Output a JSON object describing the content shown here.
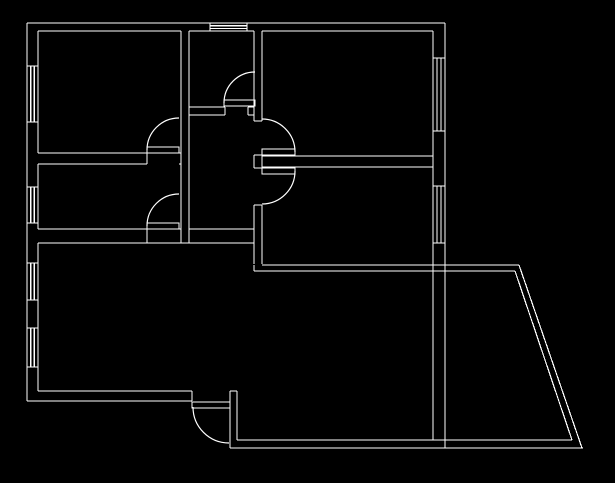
{
  "app": {
    "background_color": "#000000",
    "line_color": "#ffffff",
    "drawing_type": "apartment-floor-plan"
  },
  "plan": {
    "canvas": {
      "width": 615,
      "height": 483
    },
    "exterior_walls": [
      [
        27,
        23,
        445,
        23
      ],
      [
        27,
        23,
        27,
        401
      ],
      [
        445,
        23,
        445,
        448
      ],
      [
        38,
        31,
        181,
        31
      ],
      [
        189,
        31,
        254,
        31
      ],
      [
        262,
        31,
        433,
        31
      ],
      [
        38,
        31,
        38,
        153
      ],
      [
        38,
        164,
        38,
        229
      ],
      [
        38,
        243,
        38,
        391
      ],
      [
        433,
        31,
        433,
        440
      ],
      [
        38,
        391,
        192,
        391
      ],
      [
        27,
        401,
        192,
        401
      ],
      [
        192,
        391,
        192,
        401
      ],
      [
        230,
        391,
        230,
        448
      ],
      [
        237,
        391,
        237,
        440
      ],
      [
        230,
        391,
        237,
        391
      ],
      [
        237,
        440,
        572,
        440
      ],
      [
        230,
        448,
        583,
        448
      ],
      [
        262,
        265,
        519,
        265
      ],
      [
        254,
        271,
        515,
        271
      ],
      [
        254,
        265,
        254,
        271
      ],
      [
        519,
        265,
        582,
        448
      ],
      [
        515,
        271,
        572,
        440
      ]
    ],
    "interior_walls": [
      [
        181,
        31,
        181,
        243
      ],
      [
        189,
        31,
        189,
        243
      ],
      [
        254,
        31,
        254,
        121
      ],
      [
        254,
        155,
        254,
        168
      ],
      [
        254,
        205,
        254,
        264
      ],
      [
        262,
        31,
        262,
        121
      ],
      [
        262,
        155,
        262,
        168
      ],
      [
        262,
        205,
        262,
        264
      ],
      [
        254,
        121,
        262,
        121
      ],
      [
        254,
        155,
        262,
        155
      ],
      [
        254,
        168,
        262,
        168
      ],
      [
        254,
        205,
        262,
        205
      ],
      [
        38,
        153,
        147,
        153
      ],
      [
        38,
        164,
        147,
        164
      ],
      [
        147,
        153,
        147,
        164
      ],
      [
        179,
        153,
        181,
        153
      ],
      [
        179,
        164,
        181,
        164
      ],
      [
        189,
        107,
        225,
        107
      ],
      [
        189,
        115,
        225,
        115
      ],
      [
        248,
        107,
        254,
        107
      ],
      [
        248,
        115,
        254,
        115
      ],
      [
        225,
        107,
        225,
        115
      ],
      [
        248,
        107,
        248,
        115
      ],
      [
        262,
        156,
        433,
        156
      ],
      [
        262,
        167,
        433,
        167
      ],
      [
        38,
        229,
        147,
        229
      ],
      [
        189,
        229,
        254,
        229
      ],
      [
        179,
        229,
        181,
        229
      ],
      [
        38,
        243,
        254,
        243
      ],
      [
        147,
        229,
        147,
        243
      ]
    ],
    "windows": [
      [
        210,
        25.7,
        247,
        25.7
      ],
      [
        210,
        28.4,
        247,
        28.4
      ],
      [
        210,
        23,
        210,
        31
      ],
      [
        247,
        23,
        247,
        31
      ],
      [
        30.7,
        66,
        30.7,
        122
      ],
      [
        34.3,
        66,
        34.3,
        122
      ],
      [
        27,
        66,
        38,
        66
      ],
      [
        27,
        122,
        38,
        122
      ],
      [
        30.7,
        187,
        30.7,
        223
      ],
      [
        34.3,
        187,
        34.3,
        223
      ],
      [
        27,
        187,
        38,
        187
      ],
      [
        27,
        223,
        38,
        223
      ],
      [
        30.7,
        263,
        30.7,
        300
      ],
      [
        34.3,
        263,
        34.3,
        300
      ],
      [
        27,
        263,
        38,
        263
      ],
      [
        27,
        300,
        38,
        300
      ],
      [
        30.7,
        328,
        30.7,
        367
      ],
      [
        34.3,
        328,
        34.3,
        367
      ],
      [
        27,
        328,
        38,
        328
      ],
      [
        27,
        367,
        38,
        367
      ],
      [
        437,
        58,
        437,
        131
      ],
      [
        441,
        58,
        441,
        131
      ],
      [
        433,
        58,
        445,
        58
      ],
      [
        433,
        131,
        445,
        131
      ],
      [
        437,
        186,
        437,
        243
      ],
      [
        441,
        186,
        441,
        243
      ],
      [
        433,
        186,
        445,
        186
      ],
      [
        433,
        243,
        445,
        243
      ]
    ],
    "door_leaves": [
      {
        "x": 224,
        "y": 100,
        "w": 31,
        "h": 6
      },
      {
        "x": 262,
        "y": 149,
        "w": 33,
        "h": 6
      },
      {
        "x": 262,
        "y": 168,
        "w": 33,
        "h": 6
      },
      {
        "x": 147,
        "y": 147,
        "w": 32,
        "h": 6
      },
      {
        "x": 147,
        "y": 223,
        "w": 32,
        "h": 6
      },
      {
        "x": 192,
        "y": 402,
        "w": 38,
        "h": 6
      }
    ],
    "door_arcs": [
      {
        "sx": 224,
        "sy": 103,
        "r": 31,
        "ex": 255,
        "ey": 72,
        "sweep": 1
      },
      {
        "sx": 295,
        "sy": 152,
        "r": 33,
        "ex": 262,
        "ey": 119,
        "sweep": 0
      },
      {
        "sx": 295,
        "sy": 171,
        "r": 33,
        "ex": 262,
        "ey": 204,
        "sweep": 1
      },
      {
        "sx": 147,
        "sy": 150,
        "r": 32,
        "ex": 179,
        "ey": 118,
        "sweep": 1
      },
      {
        "sx": 147,
        "sy": 226,
        "r": 32,
        "ex": 179,
        "ey": 194,
        "sweep": 1
      },
      {
        "sx": 193,
        "sy": 407,
        "r": 36,
        "ex": 229,
        "ey": 443,
        "sweep": 0
      }
    ]
  }
}
